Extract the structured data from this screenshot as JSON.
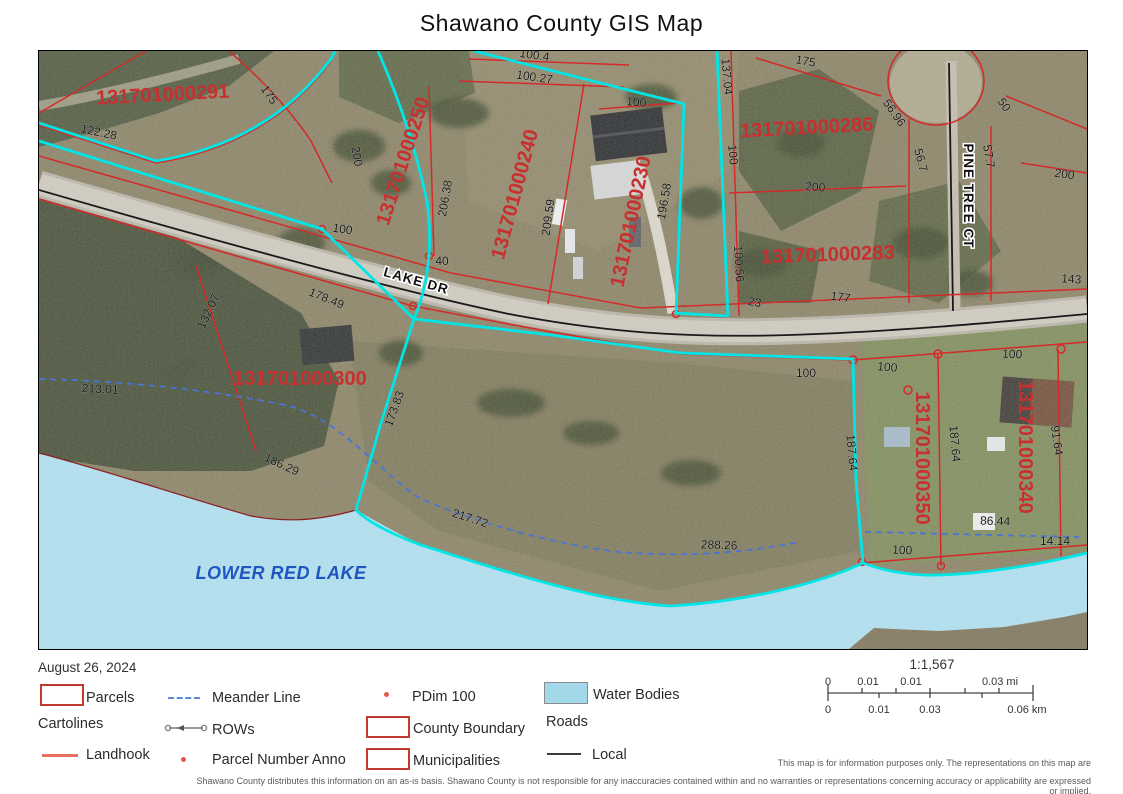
{
  "title": "Shawano County GIS Map",
  "map": {
    "water_label": {
      "t": "LOWER RED LAKE",
      "x": 242,
      "y": 528,
      "r": 0
    },
    "road_labels": [
      {
        "t": "LAKE DR",
        "x": 376,
        "y": 234,
        "r": 16
      },
      {
        "t": "PINE TREE CT",
        "x": 925,
        "y": 145,
        "r": 90
      }
    ],
    "parcel_numbers": [
      {
        "t": "131701000291",
        "x": 124,
        "y": 50,
        "r": -3
      },
      {
        "t": "131701000250",
        "x": 370,
        "y": 112,
        "r": -72
      },
      {
        "t": "131701000240",
        "x": 482,
        "y": 145,
        "r": -75
      },
      {
        "t": "131701000230",
        "x": 598,
        "y": 172,
        "r": -78
      },
      {
        "t": "131701000286",
        "x": 768,
        "y": 83,
        "r": -3
      },
      {
        "t": "131701000283",
        "x": 789,
        "y": 210,
        "r": -2
      },
      {
        "t": "131701000300",
        "x": 261,
        "y": 334,
        "r": 0
      },
      {
        "t": "131701000350",
        "x": 877,
        "y": 407,
        "r": 90
      },
      {
        "t": "131701000340",
        "x": 980,
        "y": 396,
        "r": 90
      }
    ],
    "dimensions": [
      {
        "t": "175",
        "x": 227,
        "y": 46,
        "r": 55
      },
      {
        "t": "122.28",
        "x": 59,
        "y": 85,
        "r": 12
      },
      {
        "t": "200",
        "x": 314,
        "y": 106,
        "r": 80
      },
      {
        "t": "100",
        "x": 303,
        "y": 182,
        "r": 8
      },
      {
        "t": "206.38",
        "x": 410,
        "y": 148,
        "r": -80
      },
      {
        "t": "40",
        "x": 403,
        "y": 214,
        "r": 0
      },
      {
        "t": "209.59",
        "x": 513,
        "y": 167,
        "r": -82
      },
      {
        "t": "100.4",
        "x": 495,
        "y": 8,
        "r": 8
      },
      {
        "t": "100.27",
        "x": 495,
        "y": 30,
        "r": 8
      },
      {
        "t": "100",
        "x": 597,
        "y": 55,
        "r": 4
      },
      {
        "t": "196.58",
        "x": 629,
        "y": 151,
        "r": -80
      },
      {
        "t": "137.04",
        "x": 684,
        "y": 26,
        "r": 85
      },
      {
        "t": "100",
        "x": 690,
        "y": 104,
        "r": 85
      },
      {
        "t": "100.56",
        "x": 696,
        "y": 213,
        "r": 87
      },
      {
        "t": "175",
        "x": 766,
        "y": 14,
        "r": 10
      },
      {
        "t": "56.96",
        "x": 852,
        "y": 64,
        "r": 55
      },
      {
        "t": "56.7",
        "x": 878,
        "y": 110,
        "r": 75
      },
      {
        "t": "50",
        "x": 962,
        "y": 56,
        "r": 55
      },
      {
        "t": "57.7",
        "x": 946,
        "y": 106,
        "r": 80
      },
      {
        "t": "200",
        "x": 776,
        "y": 140,
        "r": 4
      },
      {
        "t": "200",
        "x": 1025,
        "y": 127,
        "r": 8
      },
      {
        "t": "143",
        "x": 1032,
        "y": 232,
        "r": 4
      },
      {
        "t": "23",
        "x": 715,
        "y": 255,
        "r": 10
      },
      {
        "t": "177",
        "x": 801,
        "y": 250,
        "r": 8
      },
      {
        "t": "178.49",
        "x": 286,
        "y": 251,
        "r": 22
      },
      {
        "t": "213.01",
        "x": 61,
        "y": 342,
        "r": 3
      },
      {
        "t": "132.07",
        "x": 173,
        "y": 262,
        "r": -65
      },
      {
        "t": "186.29",
        "x": 241,
        "y": 417,
        "r": 25
      },
      {
        "t": "173.83",
        "x": 359,
        "y": 359,
        "r": -70
      },
      {
        "t": "217.72",
        "x": 430,
        "y": 471,
        "r": 18
      },
      {
        "t": "288.26",
        "x": 680,
        "y": 498,
        "r": 2
      },
      {
        "t": "187.64",
        "x": 809,
        "y": 402,
        "r": 85
      },
      {
        "t": "187.64",
        "x": 912,
        "y": 393,
        "r": 85
      },
      {
        "t": "91.64",
        "x": 1014,
        "y": 390,
        "r": 82
      },
      {
        "t": "100",
        "x": 767,
        "y": 326,
        "r": 0
      },
      {
        "t": "100",
        "x": 848,
        "y": 320,
        "r": 5
      },
      {
        "t": "100",
        "x": 973,
        "y": 307,
        "r": 3
      },
      {
        "t": "100",
        "x": 863,
        "y": 503,
        "r": 3
      },
      {
        "t": "86.44",
        "x": 956,
        "y": 474,
        "r": 2
      },
      {
        "t": "14.14",
        "x": 1016,
        "y": 494,
        "r": 0
      }
    ]
  },
  "legend": {
    "date": "August 26, 2024",
    "items": [
      {
        "label": "Parcels",
        "swatch": "rect-outline-red"
      },
      {
        "label": "Cartolines",
        "swatch": "none"
      },
      {
        "label": "Landhook",
        "swatch": "line-salmon"
      },
      {
        "label": "Meander Line",
        "swatch": "line-blue-dashed"
      },
      {
        "label": "ROWs",
        "swatch": "line-gray-row"
      },
      {
        "label": "Parcel Number Anno",
        "swatch": "dot-red"
      },
      {
        "label": "PDim 100",
        "swatch": "dot-red"
      },
      {
        "label": "County Boundary",
        "swatch": "rect-outline-red"
      },
      {
        "label": "Municipalities",
        "swatch": "rect-outline-red"
      },
      {
        "label": "Water Bodies",
        "swatch": "rect-fill-blue"
      },
      {
        "label": "Roads",
        "swatch": "none"
      },
      {
        "label": "Local",
        "swatch": "line-darkgray"
      }
    ]
  },
  "scale_bar": {
    "ratio": "1:1,567",
    "miles_labels": [
      "0",
      "0.01",
      "0.01",
      "0.03 mi"
    ],
    "km_labels": [
      "0",
      "0.01",
      "0.03",
      "0.06 km"
    ]
  },
  "disclaimer": {
    "line1": "This map is for information purposes only.  The representations on this map are",
    "line2": "Shawano County distributes this information on an as-is basis.  Shawano County is not responsible for any inaccuracies contained within and no warranties or representations concerning accuracy or applicability are expressed or implied."
  },
  "colors": {
    "parcel_line": "#d42a2a",
    "parcel_anno": "#c92f2f",
    "municipal_boundary": "#00e6e6",
    "meander_line": "#4a74d6",
    "water_fill": "#a9dbed",
    "lake_label": "#1f55c0"
  }
}
